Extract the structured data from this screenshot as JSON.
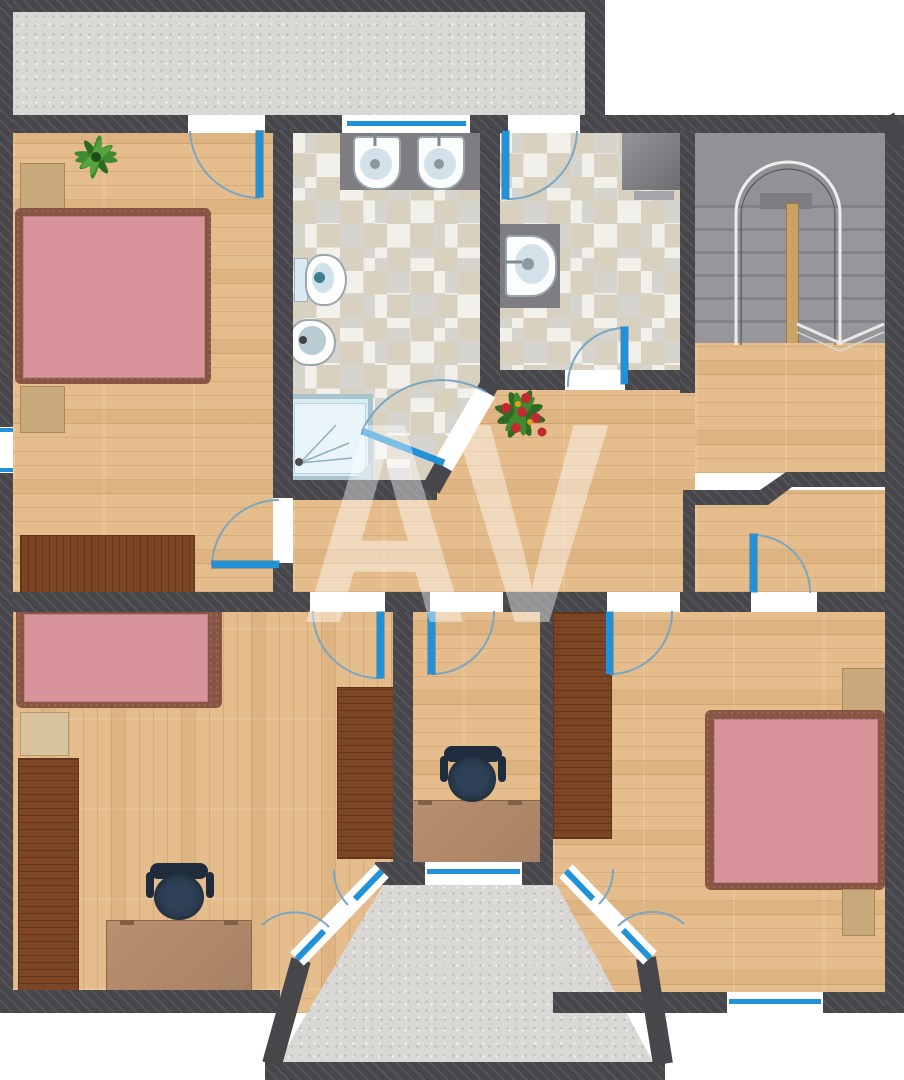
{
  "watermark": {
    "text": "AV"
  },
  "palette": {
    "wall": "#47474b",
    "wood": "#e5bd8d",
    "concrete": "#d9d8d4",
    "tileLight": "#f2f0ea",
    "tileBeige": "#d9d1c0",
    "blue": "#2191d8",
    "arc": "#7ba6c2",
    "pink": "#d9939b",
    "bedframe": "#875541",
    "darkwood": "#7c4523",
    "lightwood": "#c8a97b",
    "desk": "#b68d6d",
    "chairDark": "#1f2c3e",
    "chairSeat": "#2e4156",
    "fixture": "#7d7d82",
    "showerFill": "#d8ecf4",
    "stair": "#929296",
    "plantGreen": "#3f8a2e",
    "plantRed": "#c12a2e"
  },
  "plan": {
    "type": "floor-plan",
    "rooms": [
      {
        "name": "terrace",
        "floor": "concrete",
        "furniture": []
      },
      {
        "name": "bedroom-upper-left",
        "floor": "wood",
        "furniture": [
          "double-bed-pink",
          "nightstand",
          "dresser",
          "sideboard",
          "plant"
        ],
        "doors": [
          "terrace-door",
          "hallway-door"
        ],
        "windows": 1
      },
      {
        "name": "bathroom",
        "floor": "checkered-tile",
        "furniture": [
          "double-washbasin-vanity",
          "toilet",
          "bidet",
          "shower"
        ],
        "doors": [
          "hallway-door-diagonal"
        ],
        "windows": 1
      },
      {
        "name": "wc",
        "floor": "checkered-tile",
        "furniture": [
          "washbasin",
          "corner-cabinet"
        ],
        "doors": [
          "terrace-door",
          "hallway-door"
        ],
        "windows": 0
      },
      {
        "name": "stairwell",
        "floor": "concrete-and-wood-landing",
        "furniture": [
          "u-turn-staircase"
        ],
        "doors": [],
        "windows": 0
      },
      {
        "name": "hallway",
        "floor": "wood",
        "furniture": [
          "plant"
        ],
        "doors": [],
        "windows": 0
      },
      {
        "name": "storage-closet",
        "floor": "wood",
        "furniture": [],
        "doors": [
          "bedroom-door"
        ],
        "windows": 0
      },
      {
        "name": "bedroom-lower-left",
        "floor": "wood",
        "furniture": [
          "single-bed-pink",
          "wardrobe",
          "wardrobe",
          "desk",
          "office-chair",
          "bench"
        ],
        "doors": [
          "hallway-door",
          "balcony-french-door"
        ],
        "windows": 0
      },
      {
        "name": "study",
        "floor": "wood",
        "furniture": [
          "desk",
          "office-chair"
        ],
        "doors": [
          "hallway-door"
        ],
        "windows": 1
      },
      {
        "name": "bedroom-lower-right",
        "floor": "wood",
        "furniture": [
          "double-bed-pink",
          "nightstand",
          "nightstand",
          "wardrobe"
        ],
        "doors": [
          "hallway-door",
          "closet-door",
          "balcony-french-door"
        ],
        "windows": 1
      },
      {
        "name": "balcony",
        "floor": "concrete",
        "furniture": [],
        "doors": [
          "french-door-left",
          "french-door-right"
        ],
        "windows": 1
      }
    ],
    "door_count": 11,
    "window_count": 4
  }
}
